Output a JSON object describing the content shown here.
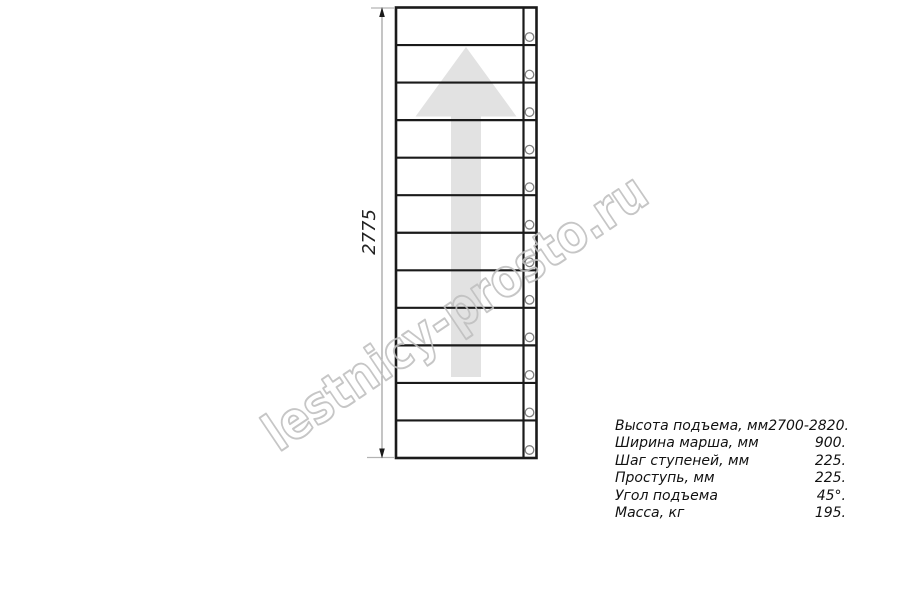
{
  "diagram": {
    "title_hint": "plan view of straight staircase flight",
    "dimension_label": "2775",
    "watermark": "lestnicy-prosto.ru",
    "direction_arrow": "up-arrow",
    "stair": {
      "treads": 12,
      "holes_per_tread": 1
    }
  },
  "specs": {
    "rows": [
      {
        "label": "Высота подъема, мм",
        "value": "2700-2820."
      },
      {
        "label": "Ширина марша, мм",
        "value": "900."
      },
      {
        "label": "Шаг ступеней, мм",
        "value": "225."
      },
      {
        "label": "Проступь, мм",
        "value": "225."
      },
      {
        "label": "Угол подъема",
        "value": "45°."
      },
      {
        "label": "Масса, кг",
        "value": "195."
      }
    ]
  },
  "colors": {
    "line": "#1a1a1a",
    "dimension": "#9e9e9e",
    "arrow_fill": "#e2e2e2",
    "watermark": "#bfbfbf",
    "text": "#111111"
  }
}
